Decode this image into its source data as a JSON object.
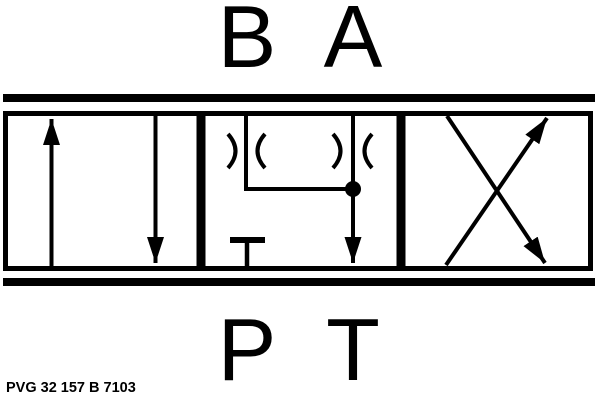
{
  "ports": {
    "top": [
      "B",
      "A"
    ],
    "bottom": [
      "P",
      "T"
    ]
  },
  "footer": {
    "code": "PVG 32 157 B 7103"
  },
  "colors": {
    "line": "#000000",
    "background": "#ffffff"
  },
  "schematic": {
    "positions": [
      {
        "id": "left",
        "symbols": [
          "arrow-up",
          "arrow-down"
        ]
      },
      {
        "id": "center",
        "symbols": [
          "restrictor-b",
          "restrictor-a",
          "junction-dot",
          "arrow-down-to-tank",
          "blocked-port-t-bar"
        ]
      },
      {
        "id": "right",
        "symbols": [
          "crossed-arrows"
        ]
      }
    ]
  }
}
